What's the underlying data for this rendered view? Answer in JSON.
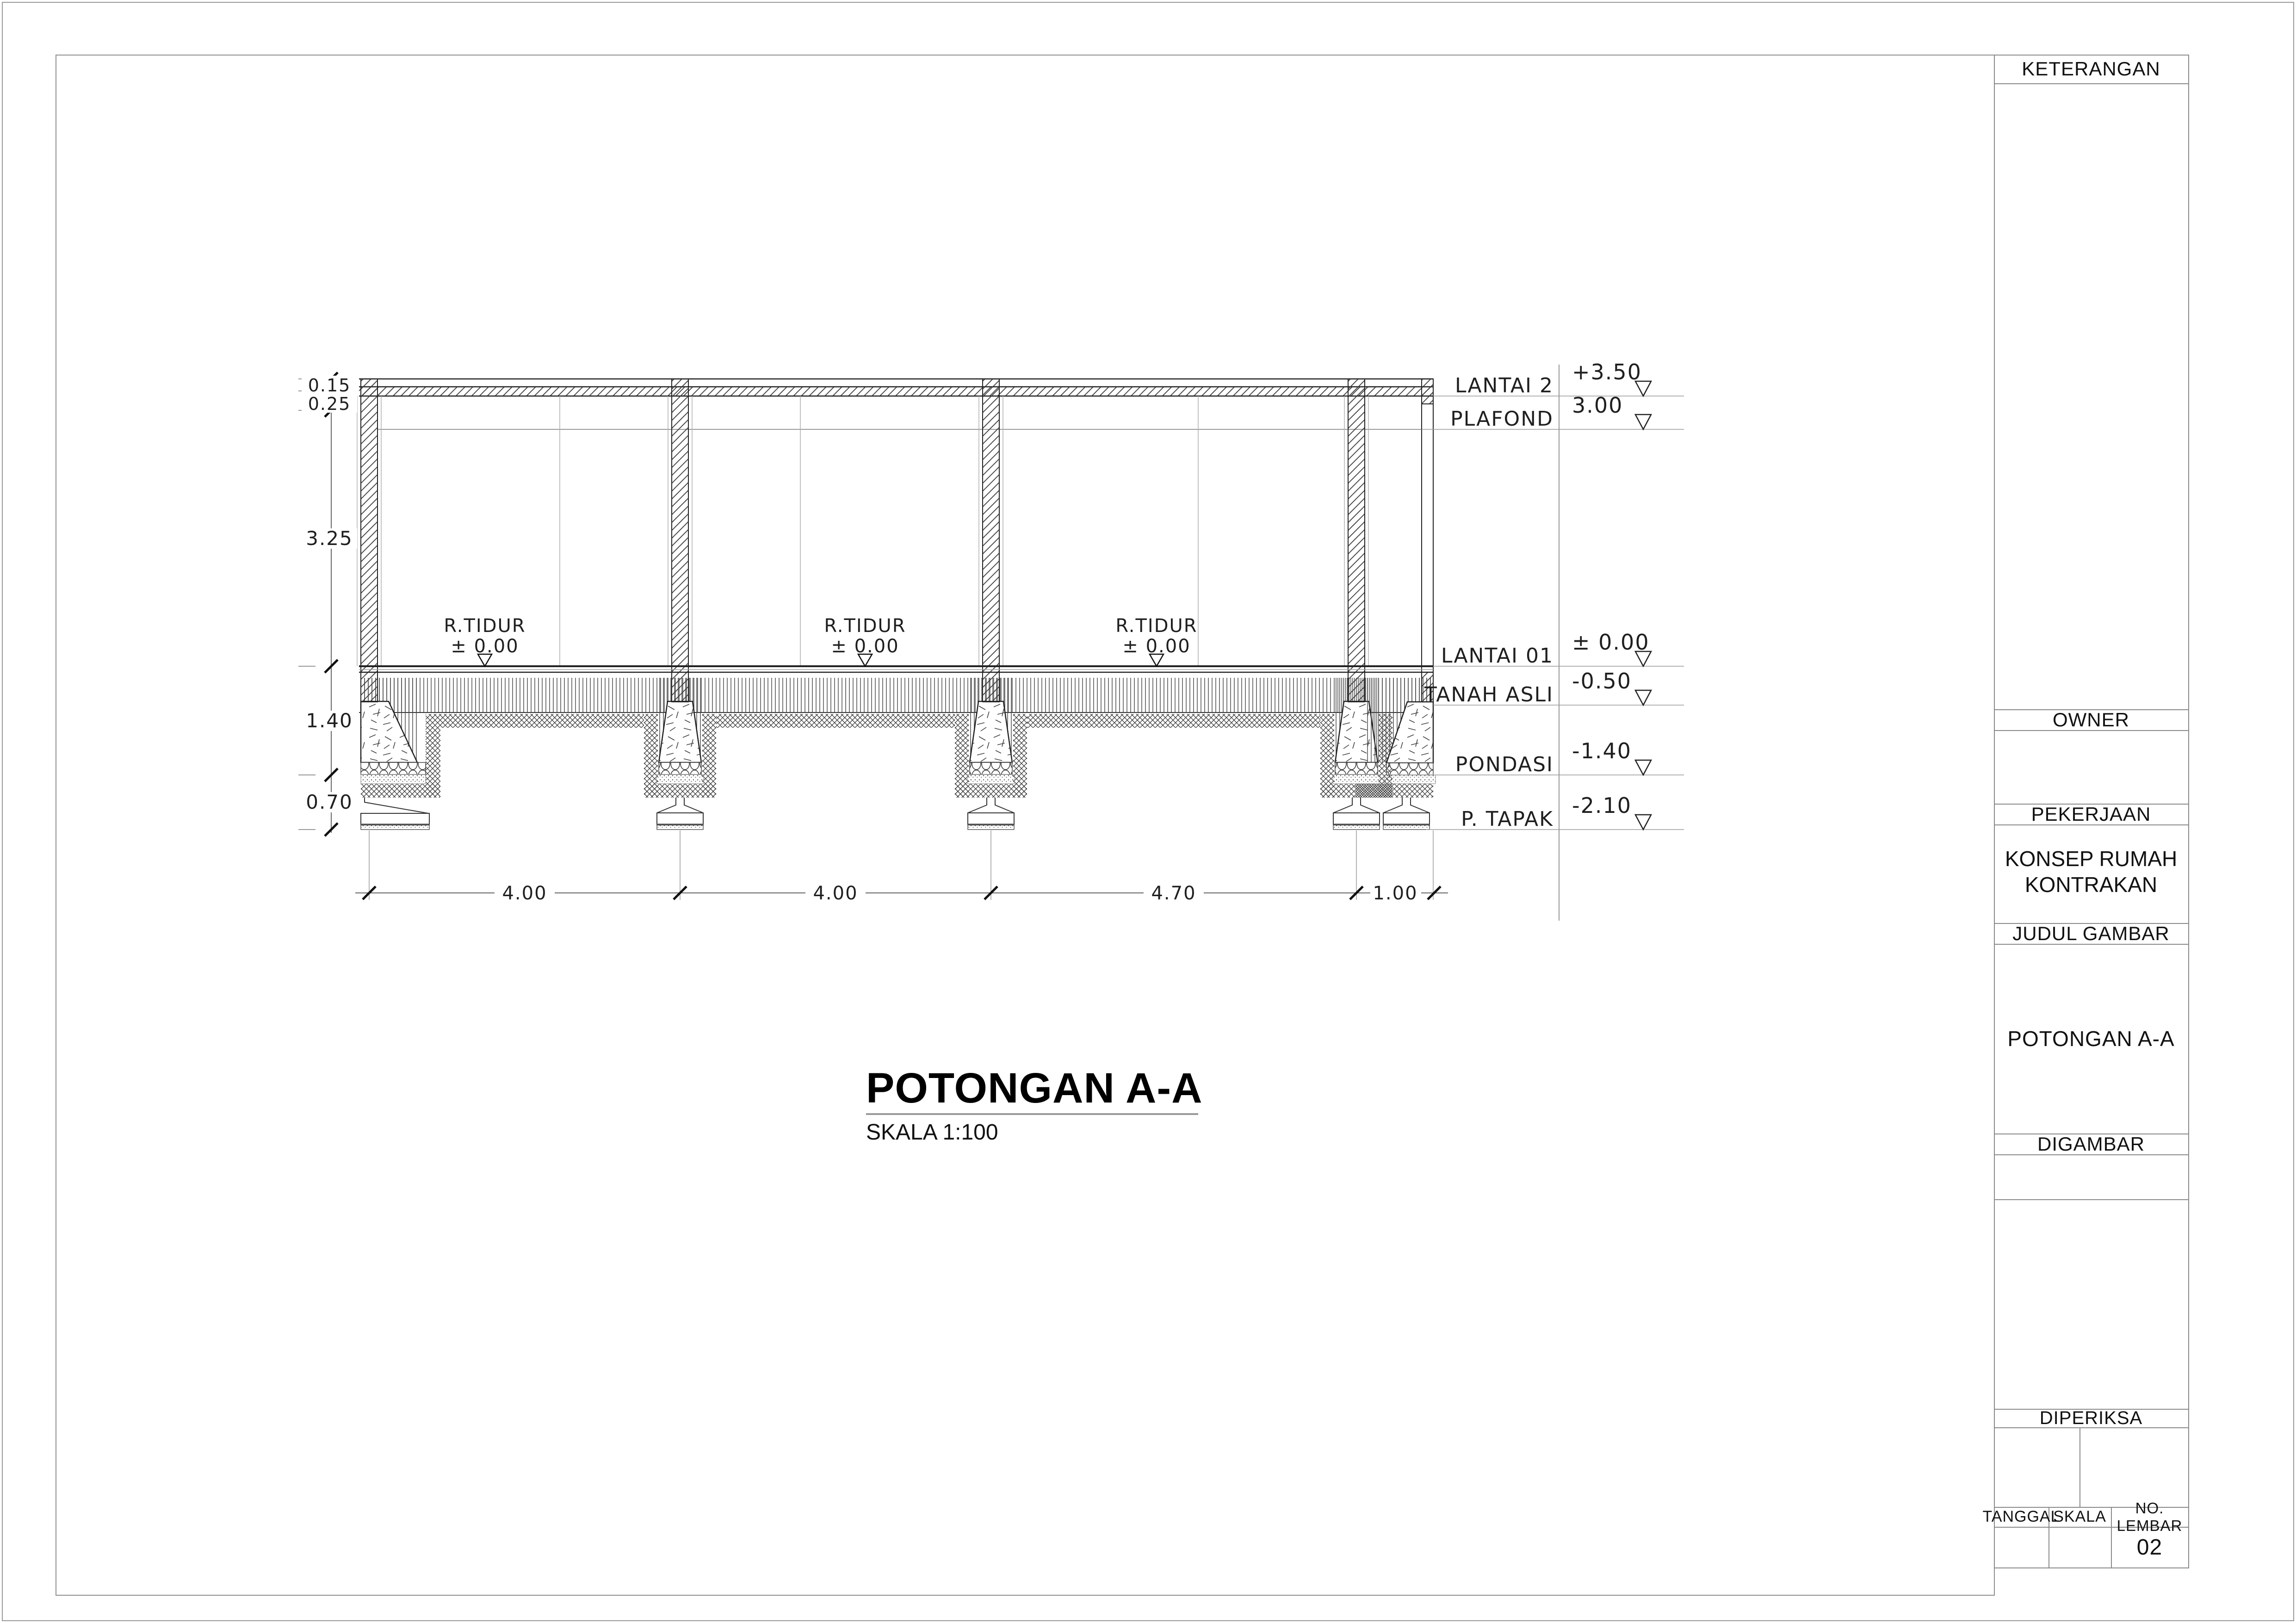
{
  "drawing": {
    "title": "POTONGAN A-A",
    "scale": "SKALA 1:100",
    "rooms": [
      {
        "name": "R.TIDUR",
        "level": "± 0.00"
      },
      {
        "name": "R.TIDUR",
        "level": "± 0.00"
      },
      {
        "name": "R.TIDUR",
        "level": "± 0.00"
      }
    ],
    "levels": [
      {
        "label": "LANTAI 2",
        "value": "+3.50"
      },
      {
        "label": "PLAFOND",
        "value": "3.00"
      },
      {
        "label": "LANTAI 01",
        "value": "± 0.00"
      },
      {
        "label": "TANAH ASLI",
        "value": "-0.50"
      },
      {
        "label": "PONDASI",
        "value": "-1.40"
      },
      {
        "label": "P. TAPAK",
        "value": "-2.10"
      }
    ],
    "dims_horizontal": [
      "4.00",
      "4.00",
      "4.70",
      "1.00"
    ],
    "dims_vertical": [
      "0.15",
      "0.25",
      "3.25",
      "1.40",
      "0.70"
    ]
  },
  "titleblock": {
    "keterangan_label": "KETERANGAN",
    "owner_label": "OWNER",
    "pekerjaan_label": "PEKERJAAN",
    "pekerjaan_value_lines": [
      "KONSEP RUMAH",
      "KONTRAKAN"
    ],
    "judul_label": "JUDUL GAMBAR",
    "judul_value": "POTONGAN A-A",
    "digambar_label": "DIGAMBAR",
    "diperiksa_label": "DIPERIKSA",
    "tanggal_label": "TANGGAL",
    "skala_label": "SKALA",
    "no_lembar_label": "NO. LEMBAR",
    "no_lembar_value": "02"
  },
  "colors": {
    "line": "#1f1f1f",
    "gray": "#8a8a8a",
    "accent": "#000000"
  }
}
